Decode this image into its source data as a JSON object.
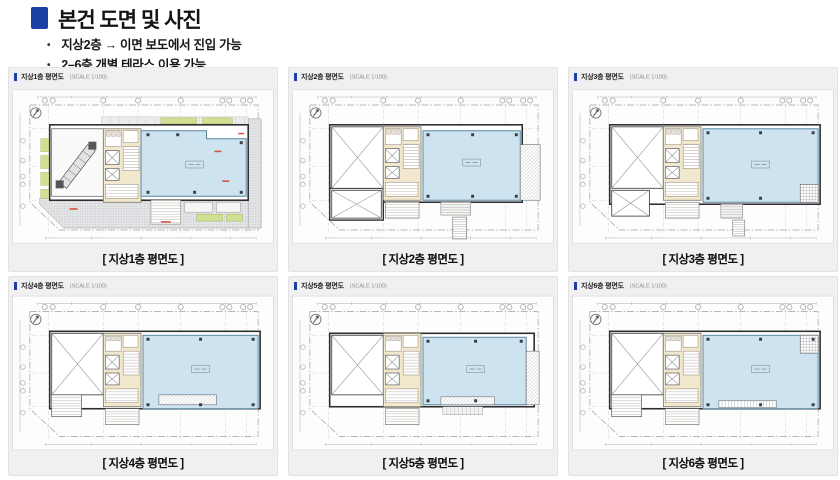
{
  "header": {
    "title": "본건 도면 및 사진",
    "bullets": [
      "지상2층 → 이면 보도에서 진입 가능",
      "2–6층 개별 테라스 이용 가능"
    ]
  },
  "colors": {
    "accent_blue": "#1b3fa5",
    "plan_blue": "#cde3ef",
    "plan_cream": "#f2e8cd",
    "plan_green": "#cfe092",
    "hatch_gray": "#9aa0a5",
    "wall": "#2e2e31",
    "red_note": "#d03a2d"
  },
  "panels": [
    {
      "floor": 1,
      "title": "지상1층 평면도",
      "scale": "(SCALE 1/100)",
      "caption": "[ 지상1층 평면도 ]"
    },
    {
      "floor": 2,
      "title": "지상2층 평면도",
      "scale": "(SCALE 1/100)",
      "caption": "[ 지상2층 평면도 ]"
    },
    {
      "floor": 3,
      "title": "지상3층 평면도",
      "scale": "(SCALE 1/100)",
      "caption": "[ 지상3층 평면도 ]"
    },
    {
      "floor": 4,
      "title": "지상4층 평면도",
      "scale": "(SCALE 1/100)",
      "caption": "[ 지상4층 평면도 ]"
    },
    {
      "floor": 5,
      "title": "지상5층 평면도",
      "scale": "(SCALE 1/100)",
      "caption": "[ 지상5층 평면도 ]"
    },
    {
      "floor": 6,
      "title": "지상6층 평면도",
      "scale": "(SCALE 1/100)",
      "caption": "[ 지상6층 평면도 ]"
    }
  ]
}
